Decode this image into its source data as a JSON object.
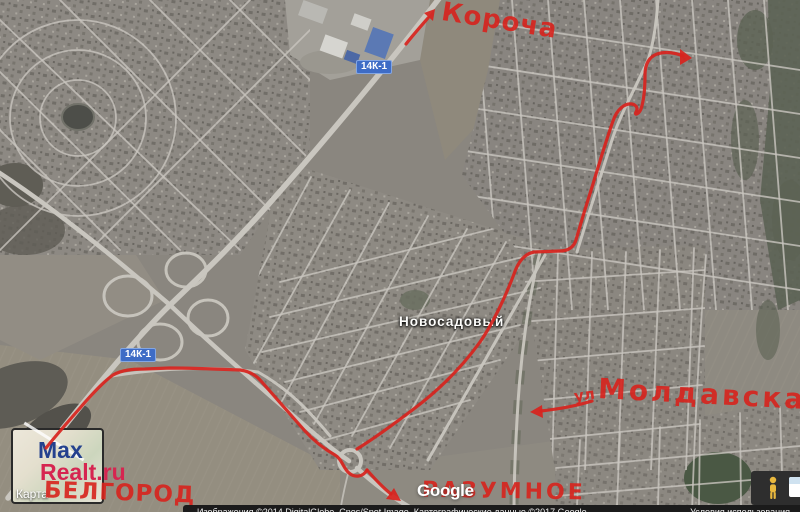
{
  "map_labels": {
    "settlement": "Новосадовый",
    "road_badge_1": "14К-1",
    "road_badge_2": "14К-1"
  },
  "annotations": {
    "destination_top": "Короча",
    "street_prefix": "ул",
    "street_name": "Молдавская",
    "city_bottom_left": "БЕЛГОРОД",
    "settlement_bottom": "РАЗУМНОЕ"
  },
  "watermark": {
    "brand": "Google"
  },
  "attribution": {
    "imagery": "Изображения ©2014 DigitalGlobe, Cnes/Spot Image, Картографические данные ©2017 Google",
    "terms": "Условия использования"
  },
  "logo": {
    "line1": "Max",
    "line2": "Realt.ru",
    "caption": "Карта"
  },
  "controls": {
    "pegman": "pegman-icon",
    "map_type": "map-type-thumbnail"
  },
  "colors": {
    "annotation_red": "#d8231d",
    "badge_blue": "#3e6cc6",
    "badge_border": "#83a6e3",
    "road": "#c9c6bf",
    "map_base": "#8a867f",
    "forest": "#5c6354",
    "field": "#948e80",
    "logo_blue": "#24418e",
    "logo_red": "#d62550",
    "bar_bg": "#1b1b1b"
  }
}
